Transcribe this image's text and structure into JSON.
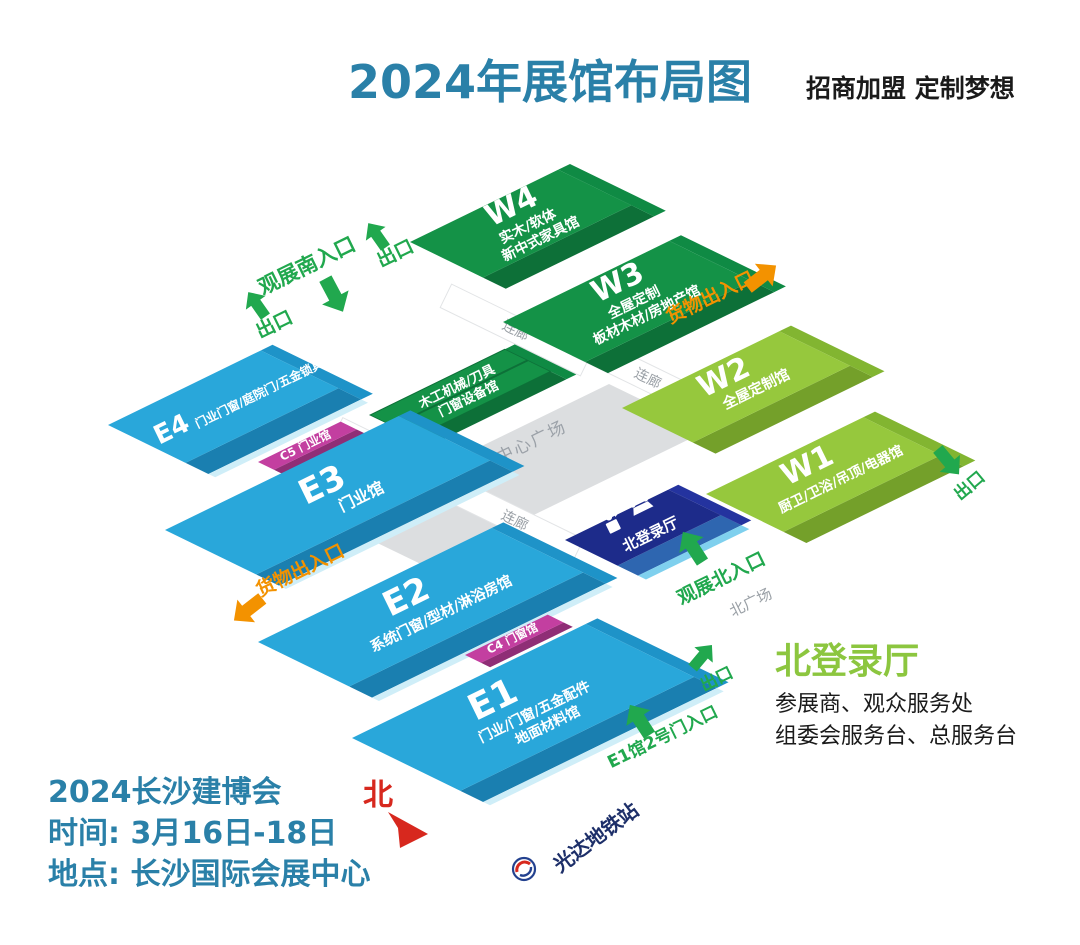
{
  "header": {
    "title": "2024年展馆布局图",
    "slogan": "招商加盟 定制梦想"
  },
  "halls": {
    "w4": {
      "code": "W4",
      "line1": "实木/软体",
      "line2": "新中式家具馆"
    },
    "w3": {
      "code": "W3",
      "line1": "全屋定制",
      "line2": "板材木材/房地产馆"
    },
    "w2": {
      "code": "W2",
      "line1": "全屋定制馆"
    },
    "w1": {
      "code": "W1",
      "line1": "厨卫/卫浴/吊顶/电器馆"
    },
    "e4": {
      "code": "E4",
      "line1": "门业门窗/庭院门/五金锁具馆"
    },
    "e3": {
      "code": "E3",
      "line1": "门业馆"
    },
    "e2": {
      "code": "E2",
      "line1": "系统门窗/型材/淋浴房馆"
    },
    "e1": {
      "code": "E1",
      "line1": "门业/门窗/五金配件",
      "line2": "地面材料馆"
    },
    "center": {
      "line1": "木工机械/刀具",
      "line2": "门窗设备馆"
    },
    "north_hall": {
      "label": "北登录厅"
    }
  },
  "connectors": {
    "c5": "C5 门业馆",
    "c4": "C4 门窗馆"
  },
  "corridor_label": "连廊",
  "plaza": {
    "center": "中心广场",
    "north": "北广场"
  },
  "gates": {
    "south_entrance": "观展南入口",
    "north_entrance": "观展北入口",
    "goods_ne": "货物出入口",
    "goods_sw": "货物出入口",
    "e1_gate2": "E1馆2号门入口",
    "exit_label": "出口"
  },
  "compass": {
    "north": "北"
  },
  "metro": {
    "label": "光达地铁站"
  },
  "footer_left": {
    "line1": "2024长沙建博会",
    "line2": "时间: 3月16日-18日",
    "line3": "地点: 长沙国际会展中心"
  },
  "legend": {
    "title": "北登录厅",
    "line1": "参展商、观众服务处",
    "line2": "组委会服务台、总服务台"
  },
  "colors": {
    "title_blue": "#2a80a8",
    "hall_blue": "#29a7da",
    "hall_dark_green": "#149247",
    "hall_lime": "#96c83d",
    "hall_navy": "#1d2b8a",
    "connector_magenta": "#c33fa0",
    "entrance_green": "#21a84e",
    "goods_orange": "#f39200",
    "north_red": "#d7281e",
    "legend_green": "#8cc63f",
    "metro_navy": "#1d2f69",
    "plaza_gray": "#dcdee0"
  }
}
